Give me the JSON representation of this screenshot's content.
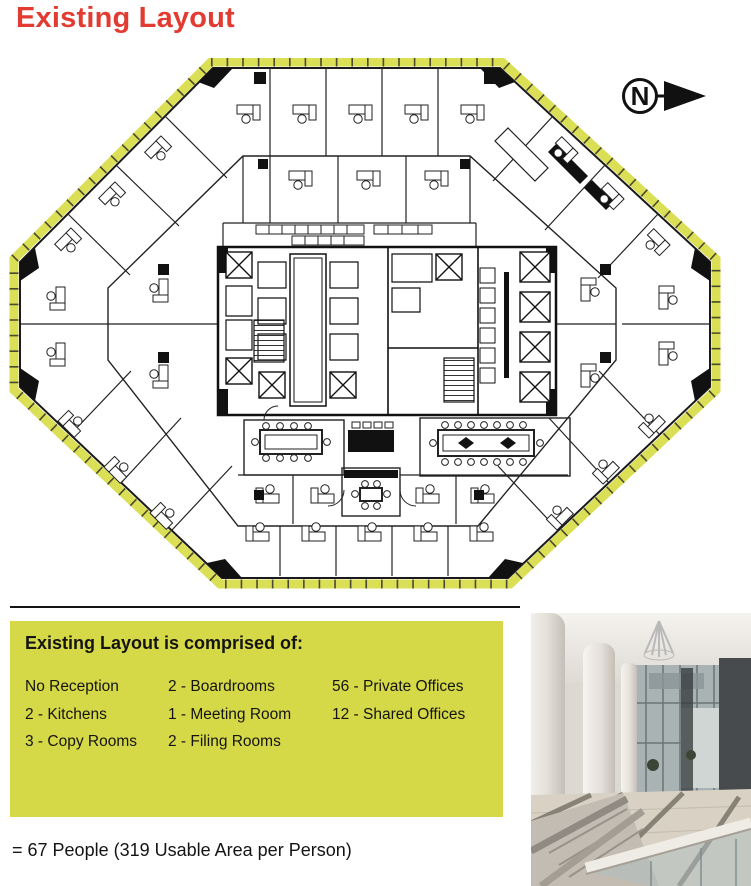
{
  "page": {
    "title": "Existing Layout"
  },
  "colors": {
    "title_red": "#e23c32",
    "summary_box_green": "#d6d947",
    "plan_perimeter_band": "#dbdf55",
    "ink": "#141414"
  },
  "floor_plan": {
    "north_label": "N",
    "icons": {
      "north_arrow_icon": "circled-N-with-right-arrow"
    }
  },
  "summary_box": {
    "heading": "Existing Layout is comprised of:",
    "columns": [
      {
        "items": [
          "No Reception",
          "2 - Kitchens",
          "3 - Copy Rooms"
        ]
      },
      {
        "items": [
          "2 - Boardrooms",
          "1 - Meeting Room",
          "2 - Filing Rooms"
        ]
      },
      {
        "items": [
          "56 - Private Offices",
          "12 - Shared Offices"
        ]
      }
    ]
  },
  "footer": {
    "people_summary": "= 67 People (319 Usable Area per Person)"
  }
}
